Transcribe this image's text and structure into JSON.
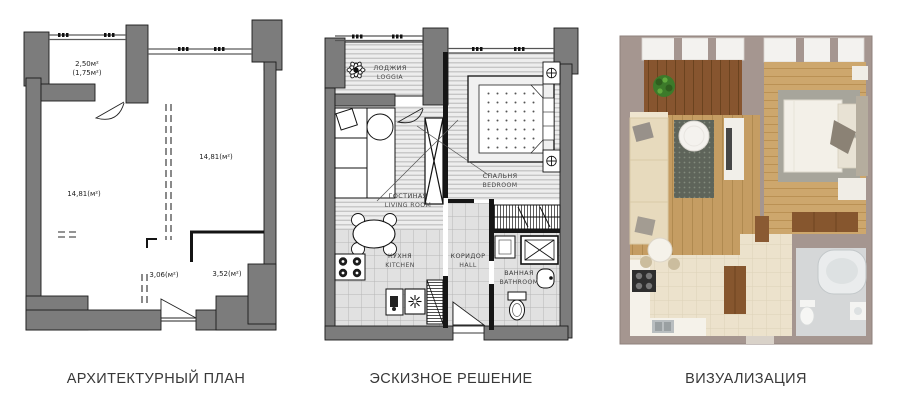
{
  "captions": {
    "architectural": "АРХИТЕКТУРНЫЙ ПЛАН",
    "sketch": "ЭСКИЗНОЕ РЕШЕНИЕ",
    "visualization": "ВИЗУАЛИЗАЦИЯ"
  },
  "architectural_plan": {
    "loggia_area": "2,50м²",
    "loggia_area_reduced": "(1,75м²)",
    "room_left_area": "14,81(м²)",
    "room_right_area": "14,81(м²)",
    "hall_area": "3,06(м²)",
    "bathroom_area": "3,52(м²)"
  },
  "sketch_plan": {
    "loggia_ru": "ЛОДЖИЯ",
    "loggia_en": "LOGGIA",
    "bedroom_ru": "СПАЛЬНЯ",
    "bedroom_en": "BEDROOM",
    "living_ru": "ГОСТИНАЯ",
    "living_en": "LIVING ROOM",
    "kitchen_ru": "КУХНЯ",
    "kitchen_en": "KITCHEN",
    "hall_ru": "КОРИДОР",
    "hall_en": "HALL",
    "bathroom_ru": "ВАННАЯ",
    "bathroom_en": "BATHROOM"
  },
  "colors": {
    "wall_gray": "#7c7c7c",
    "wall_taupe": "#a59690",
    "loggia_wood": "#87552f",
    "room_wood": "#c59d63",
    "tile_cream": "#ece2cc",
    "tile_gray": "#d5d7d8",
    "plant_green": "#3c7a2a"
  }
}
